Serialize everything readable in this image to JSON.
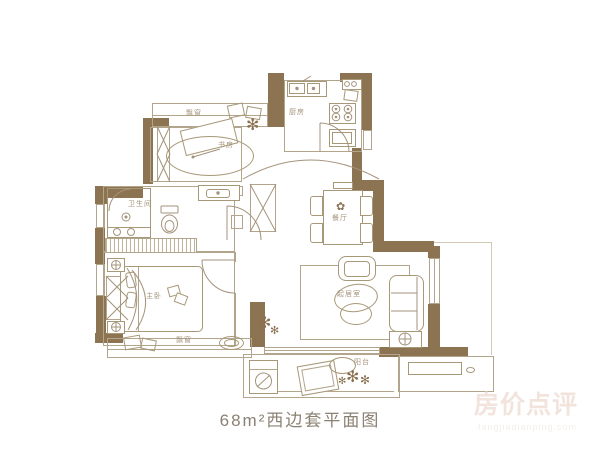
{
  "image_type": "apartment floor plan",
  "caption": "68m²西边套平面图",
  "watermark": {
    "title": "房价点评",
    "subtitle": "fangjiadianping.com"
  },
  "rooms": {
    "bay_window_top": "飘窗",
    "study": "书房",
    "kitchen": "厨房",
    "bathroom": "卫生间",
    "dining": "餐厅",
    "master_bedroom": "主卧",
    "living": "起居室",
    "bay_window_bottom": "飘窗",
    "balcony": "阳台"
  },
  "icons": {
    "plant": "✻",
    "flower": "✿"
  },
  "colors": {
    "wall": "#8c7351",
    "line": "#b3a58c",
    "furniture_line": "#a79878",
    "label": "#a4937a",
    "caption": "#8b8173",
    "watermark": "#f2e4dd",
    "background": "#ffffff"
  }
}
